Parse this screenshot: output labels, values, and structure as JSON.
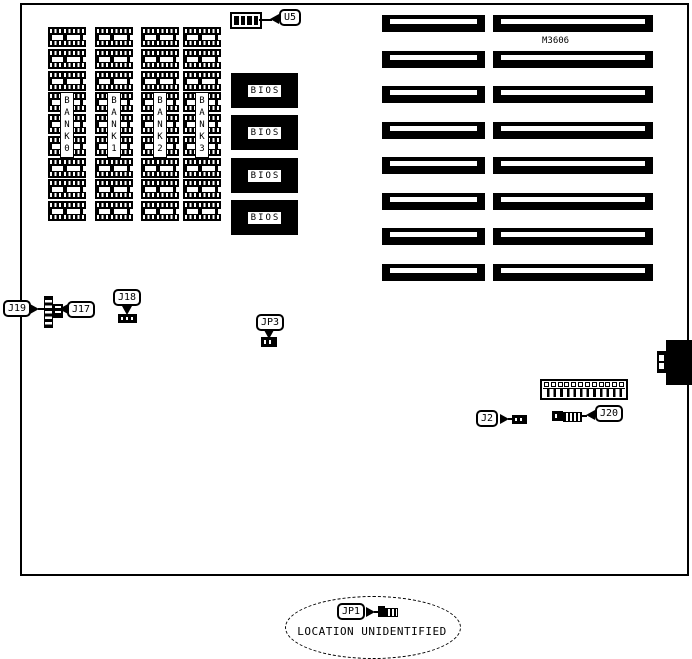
{
  "board": {
    "model": "M3606"
  },
  "memory_banks": {
    "labels": [
      "BANK0",
      "BANK1",
      "BANK2",
      "BANK3"
    ],
    "chips_per_bank": 9
  },
  "bios": {
    "label": "BIOS",
    "count": 4
  },
  "expansion_slots": {
    "rows": 8,
    "segments_per_row": 2
  },
  "connectors": {
    "u5": "U5",
    "j19": "J19",
    "j17": "J17",
    "j18": "J18",
    "jp3": "JP3",
    "j2": "J2",
    "j20": "J20",
    "jp1": "JP1",
    "j20_header_pins": 12
  },
  "note": {
    "jp1_location": "LOCATION UNIDENTIFIED"
  },
  "colors": {
    "ink": "#000000",
    "paper": "#ffffff"
  }
}
